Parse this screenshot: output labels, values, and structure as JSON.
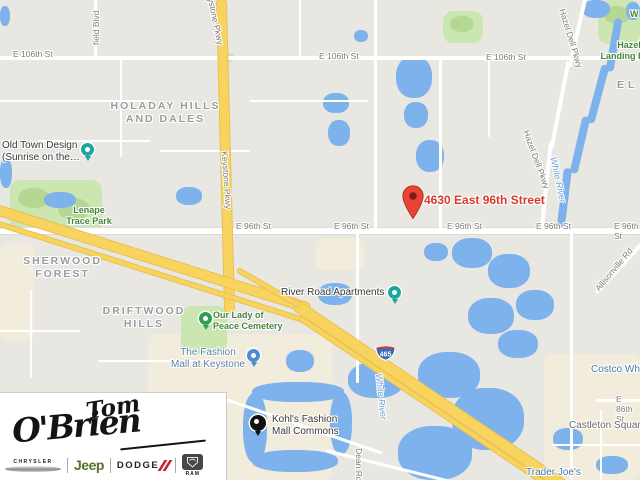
{
  "map": {
    "marker": {
      "label": "4630 East 96th Street"
    },
    "shield": {
      "number": "465"
    },
    "street_labels": [
      {
        "text": "E 106th St"
      },
      {
        "text": "E 106th St"
      },
      {
        "text": "E 106th St"
      },
      {
        "text": "E 96th St"
      },
      {
        "text": "E 96th St"
      },
      {
        "text": "E 96th St"
      },
      {
        "text": "E 96th St"
      },
      {
        "text": "E 96th St"
      },
      {
        "text": "Keystone Pkwy"
      },
      {
        "text": "Keystone Pkwy"
      },
      {
        "text": "Hazel Dell Pkwy"
      },
      {
        "text": "Hazel Dell Pkwy"
      },
      {
        "text": "Allisonville Rd"
      },
      {
        "text": "E 86th St"
      },
      {
        "text": "Dean Rd"
      },
      {
        "text": "field Blvd"
      }
    ],
    "area_labels": [
      {
        "text": "HOLADAY HILLS\nAND DALES"
      },
      {
        "text": "SHERWOOD\nFOREST"
      },
      {
        "text": "DRIFTWOOD\nHILLS"
      },
      {
        "text": "EL"
      }
    ],
    "park_labels": [
      {
        "text": "Lenape\nTrace Park"
      },
      {
        "text": "Hazel\nLanding Park"
      },
      {
        "text": "Our Lady of\nPeace Cemetery"
      },
      {
        "text": "W"
      }
    ],
    "poi_labels": [
      {
        "text": "Old Town Design\n(Sunrise on the…"
      },
      {
        "text": "River Road Apartments"
      },
      {
        "text": "Kohl's Fashion\nMall Commons"
      },
      {
        "text": "The Fashion\nMall at Keystone"
      },
      {
        "text": "Trader Joe's"
      },
      {
        "text": "Costco Wholesale"
      },
      {
        "text": "Castleton Square"
      }
    ],
    "water_labels": [
      {
        "text": "White River"
      },
      {
        "text": "White River"
      }
    ],
    "colors": {
      "marker_red": "#E94335",
      "marker_label_red": "#D53A2B",
      "highway_yellow": "#F8D45F",
      "water_blue": "#7DB2EC",
      "park_green": "#CBE6B1",
      "jeep_green": "#55702D",
      "dodge_red": "#C3272E"
    }
  },
  "logo": {
    "dealer_first": "Tom",
    "dealer_last": "O'Brien",
    "brand_chrysler": "CHRYSLER",
    "brand_jeep": "Jeep",
    "brand_dodge": "DODGE",
    "brand_ram": "RAM"
  }
}
